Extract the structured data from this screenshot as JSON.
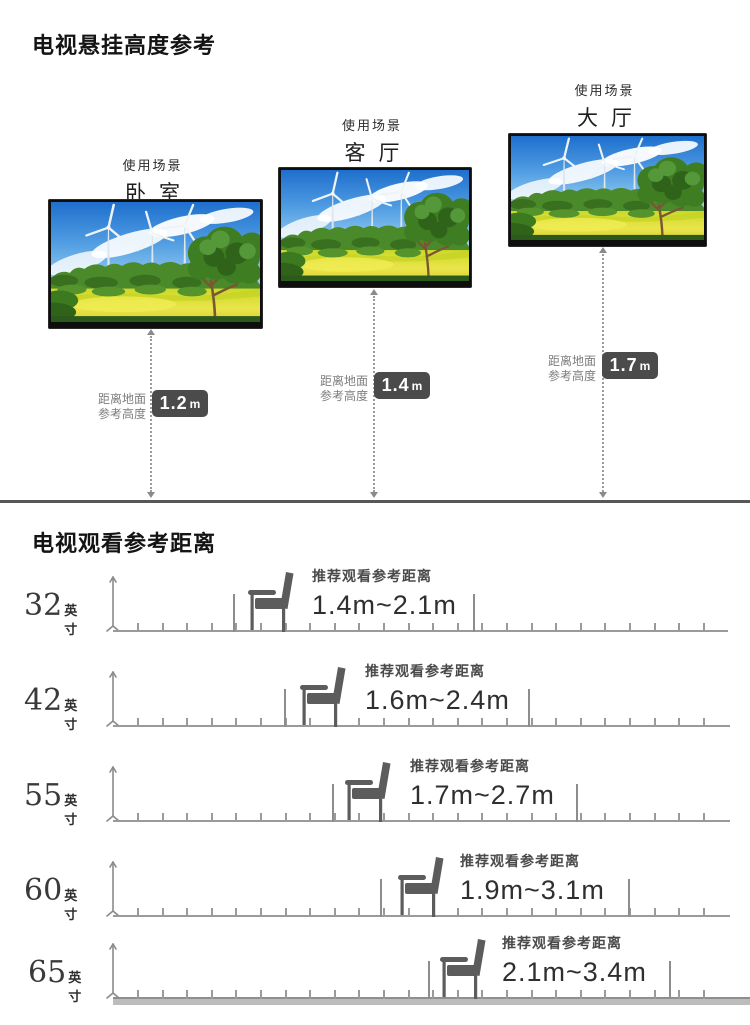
{
  "section1": {
    "title": "电视悬挂高度参考"
  },
  "section2": {
    "title": "电视观看参考距离"
  },
  "mount": {
    "scene_caption": "使用场景",
    "height_caption_line1": "距离地面",
    "height_caption_line2": "参考高度",
    "tvs": [
      {
        "scene": "卧室",
        "height_value": "1.2",
        "height_unit": "m"
      },
      {
        "scene": "客厅",
        "height_value": "1.4",
        "height_unit": "m"
      },
      {
        "scene": "大厅",
        "height_value": "1.7",
        "height_unit": "m"
      }
    ]
  },
  "viewing": {
    "recommend_caption": "推荐观看参考距离",
    "inch_unit": "英寸",
    "rows": [
      {
        "size": "32",
        "range": "1.4m~2.1m"
      },
      {
        "size": "42",
        "range": "1.6m~2.4m"
      },
      {
        "size": "55",
        "range": "1.7m~2.7m"
      },
      {
        "size": "60",
        "range": "1.9m~3.1m"
      },
      {
        "size": "65",
        "range": "2.1m~3.4m"
      }
    ]
  },
  "chart_data": {
    "type": "table",
    "title": "电视观看参考距离",
    "columns": [
      "屏幕尺寸(英寸)",
      "推荐观看参考距离(m)"
    ],
    "rows": [
      [
        32,
        1.4,
        2.1
      ],
      [
        42,
        1.6,
        2.4
      ],
      [
        55,
        1.7,
        2.7
      ],
      [
        60,
        1.9,
        3.1
      ],
      [
        65,
        2.1,
        3.4
      ]
    ],
    "mount_heights": {
      "title": "电视悬挂高度参考",
      "unit": "m",
      "items": [
        {
          "scene": "卧室",
          "height": 1.2
        },
        {
          "scene": "客厅",
          "height": 1.4
        },
        {
          "scene": "大厅",
          "height": 1.7
        }
      ]
    }
  }
}
